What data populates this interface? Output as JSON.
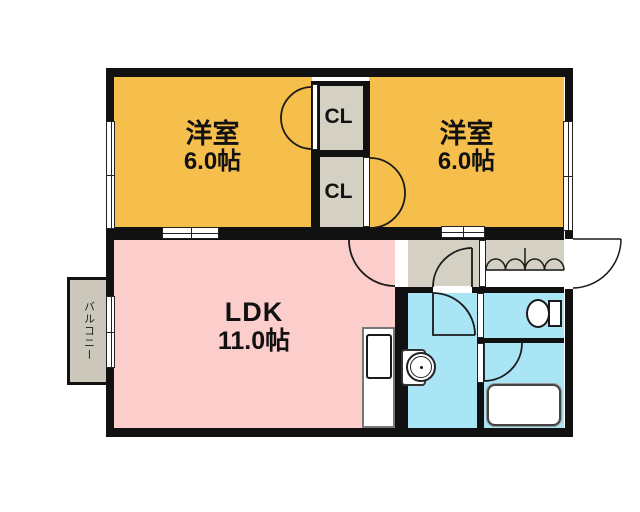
{
  "plan": {
    "bedroom_left": {
      "name": "洋室",
      "size": "6.0帖"
    },
    "bedroom_right": {
      "name": "洋室",
      "size": "6.0帖"
    },
    "ldk": {
      "name": "LDK",
      "size": "11.0帖"
    },
    "closet_top": {
      "label": "CL"
    },
    "closet_bottom": {
      "label": "CL"
    },
    "balcony": {
      "label": "バルコニー"
    },
    "colors": {
      "bedroom": "#F6BE4B",
      "ldk": "#FBCDCB",
      "wet_area": "#A9E5F5",
      "closet_and_hall": "#D4D0C3",
      "balcony": "#CBC7BA",
      "wall": "#111111"
    }
  }
}
